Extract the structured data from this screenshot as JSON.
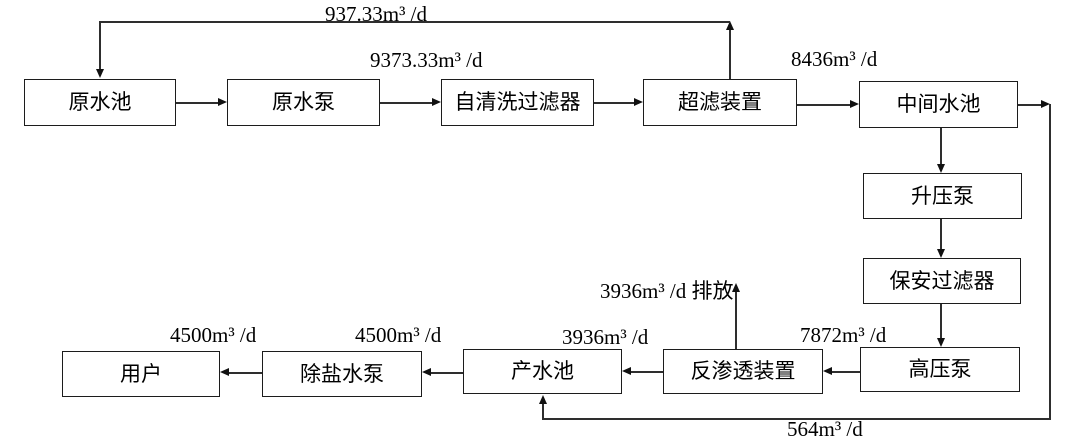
{
  "diagram_type": "process-flowchart",
  "line_color": "#2e2e2e",
  "box_border_color": "#1c1c1c",
  "background_color": "#ffffff",
  "nodes": {
    "raw_water_pool": "原水池",
    "raw_water_pump": "原水泵",
    "self_cleaning_filter": "自清洗过滤器",
    "uf_unit": "超滤装置",
    "intermediate_pool": "中间水池",
    "booster_pump": "升压泵",
    "security_filter": "保安过滤器",
    "high_pressure_pump": "高压泵",
    "ro_unit": "反渗透装置",
    "product_pool": "产水池",
    "desalted_water_pump": "除盐水泵",
    "users": "用户"
  },
  "flow_labels": {
    "uf_backwash": "937.33m³ /d",
    "raw_feed": "9373.33m³ /d",
    "uf_output": "8436m³ /d",
    "ro_discharge": "3936m³ /d 排放",
    "hp_to_ro": "7872m³ /d",
    "ro_to_pool": "3936m³ /d",
    "pool_to_pump": "4500m³ /d",
    "pump_to_user": "4500m³ /d",
    "bypass": "564m³ /d"
  },
  "edges": [
    {
      "from": "uf_unit",
      "to": "raw_water_pool",
      "label": "937.33m³ /d"
    },
    {
      "from": "raw_water_pool",
      "to": "raw_water_pump",
      "label": ""
    },
    {
      "from": "raw_water_pump",
      "to": "self_cleaning_filter",
      "label": "9373.33m³ /d"
    },
    {
      "from": "self_cleaning_filter",
      "to": "uf_unit",
      "label": ""
    },
    {
      "from": "uf_unit",
      "to": "intermediate_pool",
      "label": "8436m³ /d"
    },
    {
      "from": "intermediate_pool",
      "to": "product_pool",
      "label": "564m³ /d"
    },
    {
      "from": "intermediate_pool",
      "to": "booster_pump",
      "label": ""
    },
    {
      "from": "booster_pump",
      "to": "security_filter",
      "label": ""
    },
    {
      "from": "security_filter",
      "to": "high_pressure_pump",
      "label": ""
    },
    {
      "from": "high_pressure_pump",
      "to": "ro_unit",
      "label": "7872m³ /d"
    },
    {
      "from": "ro_unit",
      "to": "discharge-outlet",
      "label": "3936m³ /d 排放"
    },
    {
      "from": "ro_unit",
      "to": "product_pool",
      "label": "3936m³ /d"
    },
    {
      "from": "product_pool",
      "to": "desalted_water_pump",
      "label": "4500m³ /d"
    },
    {
      "from": "desalted_water_pump",
      "to": "users",
      "label": "4500m³ /d"
    }
  ]
}
